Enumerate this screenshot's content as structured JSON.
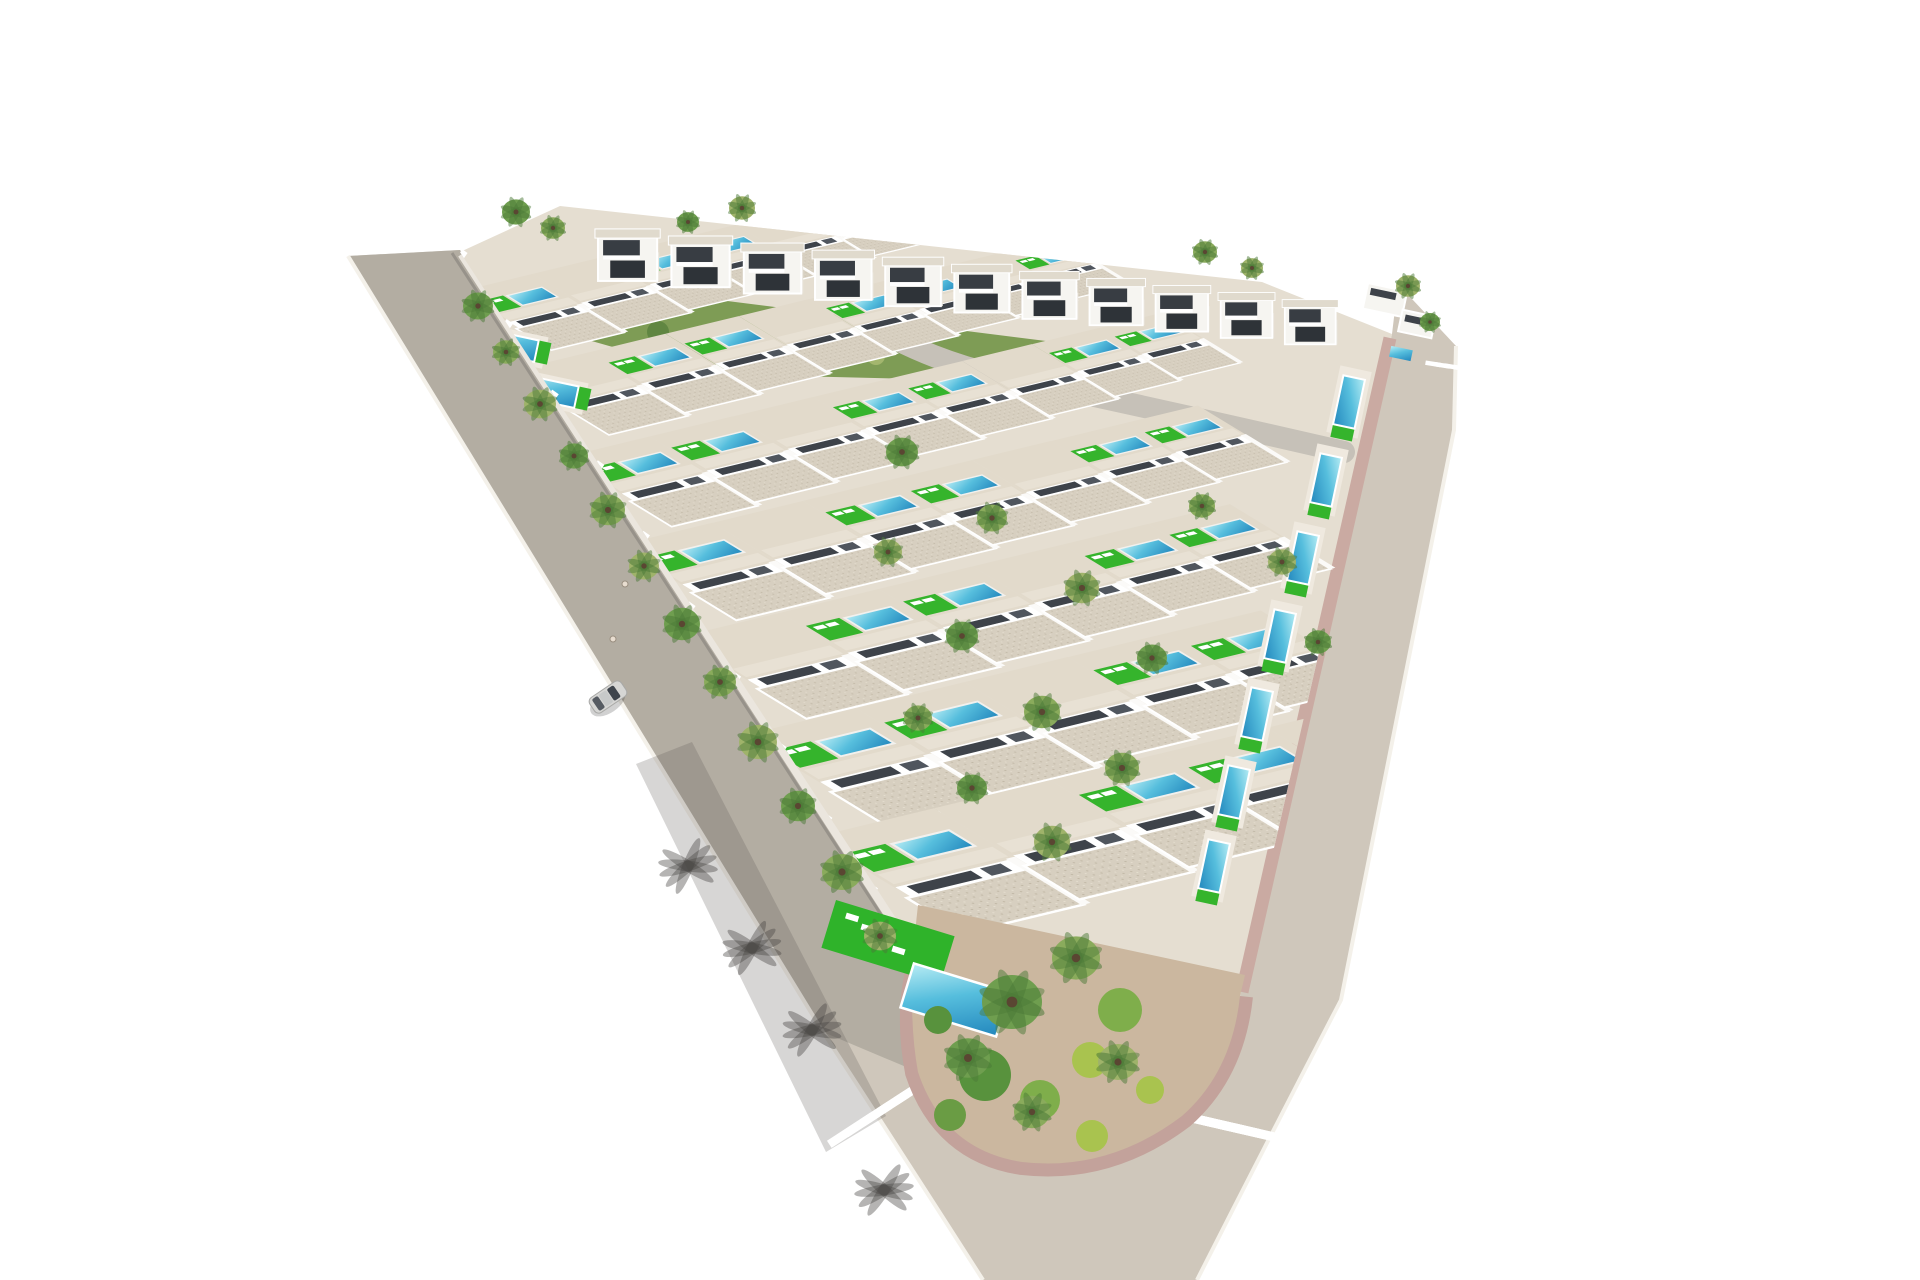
{
  "scene": {
    "alt_text": "Aerial 3D architectural render of a triangular residential development of white villas with private pools, bordered by roads with zebra crosswalks and a landscaped corner garden",
    "palette": {
      "background": "#ffffff",
      "road_main": "#cfc7bb",
      "road_left_overlay": "#a8a399",
      "road_edge_line": "#f4f1ea",
      "sidewalk_white": "#ebe6de",
      "curb_dark": "#97928a",
      "paver_pink": "#c3a29b",
      "paver_pink_light": "#caaaa2",
      "curb_gray": "#b4b2ae",
      "curb_highlight": "#e7e5e1",
      "ground": "#e5ded1",
      "garden_dirt": "#cbb79f",
      "lawn": "#2fb32a",
      "lawn_bright": "#35b42c",
      "pool_light": "#b7ecf4",
      "pool_mid": "#56bedd",
      "pool_dark": "#2387bd",
      "roof": "#d7cfc0",
      "roof_fleck_dark": "#c2b9a7",
      "roof_fleck_light": "#e5decf",
      "wall": "#f6f5f1",
      "wall_bright": "#ffffff",
      "window_dark": "#3e434a",
      "door_dark": "#50565e",
      "facade_shade": "#c9c4bb",
      "yard": "#e2dacb",
      "walkway": "#e8e1d4",
      "cube_roof": "#e0dacd",
      "cube_side": "#e9e5dc",
      "opening_upper": "#383d43",
      "opening_lower": "#2e3338",
      "internal_road": "#c6c1b8",
      "embankment": "#7e9c55",
      "embank_speckle_a": "#a7b971",
      "embank_speckle_b": "#5d8440",
      "palm_greens": [
        "#6f9e4f",
        "#8aab5c",
        "#9fb36a"
      ],
      "palm_dark": "#4c7a38",
      "palm_trunk": "#5a4632",
      "shrub_greens": [
        "#58923d",
        "#7fae4b",
        "#a9c34f",
        "#6a9c44"
      ],
      "shadow": "rgba(70,68,64,0.40)",
      "shadow_streak": "rgba(96,92,86,0.25)",
      "car_body": "#d6d6d4",
      "car_outline": "#a9a9a7",
      "car_glass": "#3f454d",
      "car_roof": "#c7c9c9",
      "car_rear": "#565b62",
      "deck": "#efe9df"
    },
    "villas": {
      "unit_pitch": 106,
      "unit_shrink": 0.955,
      "pool_modulo": 3,
      "pool_skip": 1
    },
    "villa_rows": [
      {
        "x": 462,
        "y": 292,
        "units": 8,
        "scale": 0.72
      },
      {
        "x": 512,
        "y": 372,
        "units": 8,
        "scale": 0.78
      },
      {
        "x": 566,
        "y": 458,
        "units": 8,
        "scale": 0.85
      },
      {
        "x": 622,
        "y": 546,
        "units": 7,
        "scale": 0.92
      },
      {
        "x": 682,
        "y": 638,
        "units": 6,
        "scale": 1.0
      },
      {
        "x": 748,
        "y": 736,
        "units": 5,
        "scale": 1.1
      },
      {
        "x": 818,
        "y": 838,
        "units": 5,
        "scale": 1.18
      }
    ],
    "two_story_row": {
      "x": 598,
      "y": 234,
      "units": 11,
      "pitch": 72,
      "drop": 7,
      "scale": 1.02,
      "shrink": 0.985
    },
    "edge_pools": [
      {
        "x": 1349,
        "y": 402,
        "rot": 102
      },
      {
        "x": 1326,
        "y": 480,
        "rot": 102
      },
      {
        "x": 1303,
        "y": 558,
        "rot": 102
      },
      {
        "x": 1280,
        "y": 636,
        "rot": 102
      },
      {
        "x": 1257,
        "y": 714,
        "rot": 102
      },
      {
        "x": 1234,
        "y": 792,
        "rot": 102
      },
      {
        "x": 1214,
        "y": 866,
        "rot": 102
      },
      {
        "x": 512,
        "y": 346,
        "rot": 12
      },
      {
        "x": 552,
        "y": 392,
        "rot": 12
      }
    ],
    "crosswalks": [
      {
        "x": 893,
        "y": 1103,
        "rot": 57,
        "stripes": 6,
        "len": 52,
        "w": 8.5,
        "pitch": 20
      },
      {
        "x": 1192,
        "y": 1118,
        "rot": 103,
        "stripes": 10,
        "len": 58,
        "w": 9,
        "pitch": 16
      },
      {
        "x": 1447,
        "y": 366,
        "rot": 99,
        "stripes": 4,
        "len": 15,
        "w": 4.5,
        "pitch": 9.5
      }
    ],
    "palms": [
      [
        478,
        306,
        15,
        0
      ],
      [
        506,
        352,
        13,
        1
      ],
      [
        540,
        404,
        16,
        2
      ],
      [
        574,
        456,
        14,
        0
      ],
      [
        608,
        510,
        17,
        1
      ],
      [
        644,
        566,
        15,
        2
      ],
      [
        682,
        624,
        18,
        0
      ],
      [
        720,
        682,
        16,
        1
      ],
      [
        758,
        742,
        19,
        2
      ],
      [
        798,
        806,
        17,
        0
      ],
      [
        842,
        872,
        20,
        1
      ],
      [
        880,
        936,
        16,
        2
      ],
      [
        516,
        212,
        14,
        0
      ],
      [
        553,
        228,
        12,
        1
      ],
      [
        742,
        208,
        13,
        2
      ],
      [
        688,
        222,
        11,
        0
      ],
      [
        1205,
        252,
        12,
        1
      ],
      [
        1252,
        268,
        11,
        2
      ],
      [
        902,
        452,
        16,
        0
      ],
      [
        992,
        518,
        15,
        1
      ],
      [
        1082,
        588,
        17,
        2
      ],
      [
        1152,
        658,
        15,
        0
      ],
      [
        1042,
        712,
        18,
        1
      ],
      [
        888,
        552,
        14,
        2
      ],
      [
        962,
        636,
        16,
        0
      ],
      [
        1202,
        506,
        13,
        1
      ],
      [
        1282,
        562,
        14,
        2
      ],
      [
        1318,
        642,
        13,
        0
      ],
      [
        1122,
        768,
        17,
        1
      ],
      [
        1052,
        842,
        18,
        2
      ],
      [
        972,
        788,
        15,
        0
      ],
      [
        918,
        718,
        14,
        1
      ],
      [
        1012,
        1002,
        30,
        0
      ],
      [
        1076,
        958,
        24,
        1
      ],
      [
        1118,
        1062,
        20,
        2
      ],
      [
        968,
        1058,
        22,
        0
      ],
      [
        1032,
        1112,
        18,
        1
      ],
      [
        1408,
        286,
        12,
        2
      ],
      [
        1430,
        322,
        10,
        0
      ]
    ],
    "shrubs": [
      [
        985,
        1075,
        26,
        0
      ],
      [
        1040,
        1100,
        20,
        1
      ],
      [
        1090,
        1060,
        18,
        2
      ],
      [
        950,
        1115,
        16,
        3
      ],
      [
        1120,
        1010,
        22,
        1
      ],
      [
        1150,
        1090,
        14,
        2
      ],
      [
        1092,
        1136,
        16,
        2
      ],
      [
        938,
        1020,
        14,
        0
      ]
    ],
    "palm_shadows": [
      [
        688,
        866,
        -18
      ],
      [
        752,
        948,
        -14
      ],
      [
        812,
        1030,
        -12
      ],
      [
        884,
        1190,
        -8
      ]
    ],
    "embankment_speckles": [
      [
        600,
        328
      ],
      [
        658,
        332
      ],
      [
        722,
        346
      ],
      [
        800,
        352
      ],
      [
        876,
        356
      ],
      [
        948,
        362
      ],
      [
        1016,
        368
      ]
    ],
    "corner_buildings": [
      [
        1385,
        300,
        40,
        26
      ],
      [
        1417,
        324,
        34,
        22
      ]
    ],
    "garden": {
      "lawn": {
        "x": 888,
        "y": 942,
        "rot": 17,
        "w": 124,
        "h": 50
      },
      "pool": {
        "x": 955,
        "y": 1000,
        "rot": 17,
        "w": 100,
        "h": 46
      },
      "loungers": 4
    },
    "car": {
      "x": 608,
      "y": 697,
      "rot": 56
    },
    "people": [
      [
        625,
        584
      ],
      [
        613,
        639
      ]
    ],
    "wall_posts": 11
  }
}
